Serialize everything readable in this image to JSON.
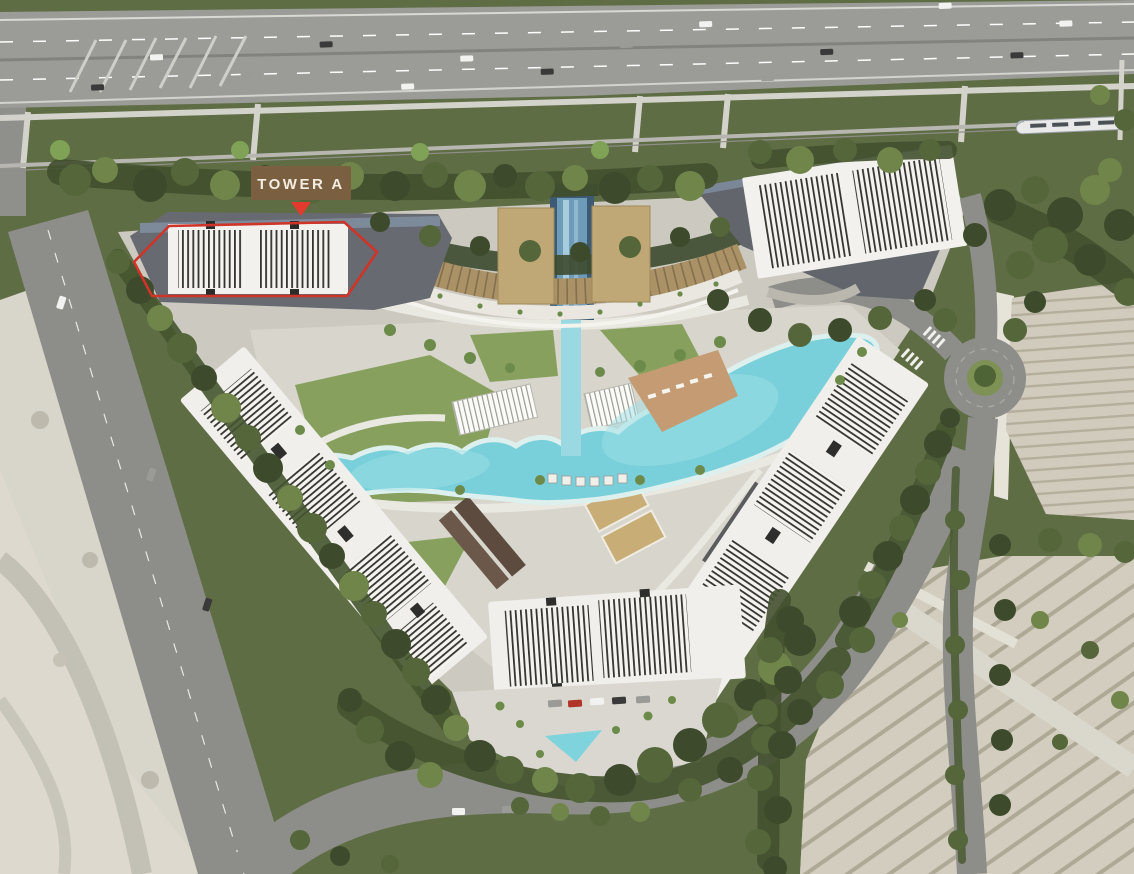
{
  "label": {
    "text": "TOWER A",
    "bg_color": "#7b5f41",
    "text_color": "#f4ede2",
    "arrow_color": "#e23a2c"
  },
  "highlight": {
    "outline_color": "#cf3429"
  },
  "palette": {
    "pool": "#79d0da",
    "roof_gold": "#ab9166",
    "grass_verge": "#5f6d45",
    "road_grey": "#8d8d89",
    "sand": "#d8d5ca",
    "building_white": "#f1f0ec",
    "podium_grey": "#63666b",
    "existing_beige": "#cbc6b7",
    "tree_dark": "#3d4b2c"
  }
}
